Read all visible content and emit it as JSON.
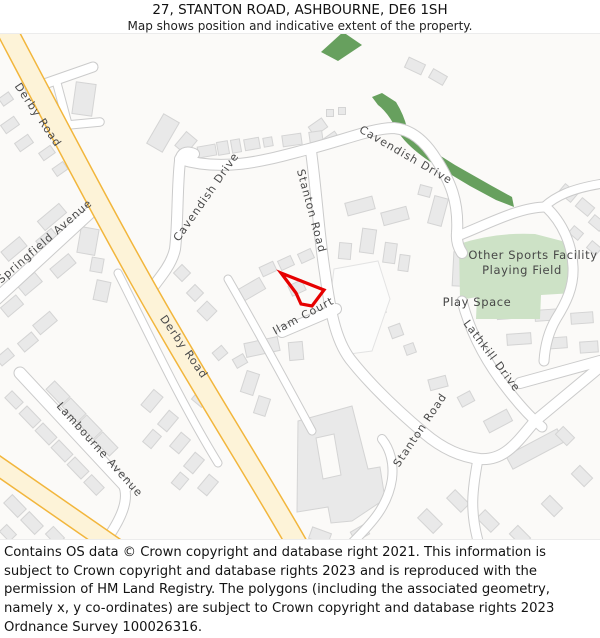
{
  "title": {
    "line1": "27, STANTON ROAD, ASHBOURNE, DE6 1SH",
    "line2": "Map shows position and indicative extent of the property."
  },
  "map": {
    "labels": {
      "derby_road": "Derby Road",
      "springfield_avenue": "Springfield Avenue",
      "cavendish_drive": "Cavendish Drive",
      "stanton_road": "Stanton Road",
      "ilam_court": "Ilam Court",
      "lambourne_avenue": "Lambourne Avenue",
      "lathkill_drive": "Lathkill Drive",
      "sports_facility_line1": "Other Sports Facility",
      "sports_facility_line2": "Playing Field",
      "play_space": "Play Space"
    },
    "colors": {
      "background": "#fbfaf8",
      "building_fill": "#e9e9e9",
      "building_stroke": "#d4d4d4",
      "road_fill": "#ffffff",
      "road_casing": "#cbcbcb",
      "primary_road_fill": "#fdf3d8",
      "primary_road_casing": "#f2b63c",
      "green_dark": "#67a05e",
      "green_light": "#cde2c6",
      "property_outline": "#e60000",
      "label_text": "#4a4a4a"
    }
  },
  "footer": {
    "text": "Contains OS data © Crown copyright and database right 2021. This information is subject to Crown copyright and database rights 2023 and is reproduced with the permission of HM Land Registry. The polygons (including the associated geometry, namely x, y co-ordinates) are subject to Crown copyright and database rights 2023 Ordnance Survey 100026316."
  }
}
